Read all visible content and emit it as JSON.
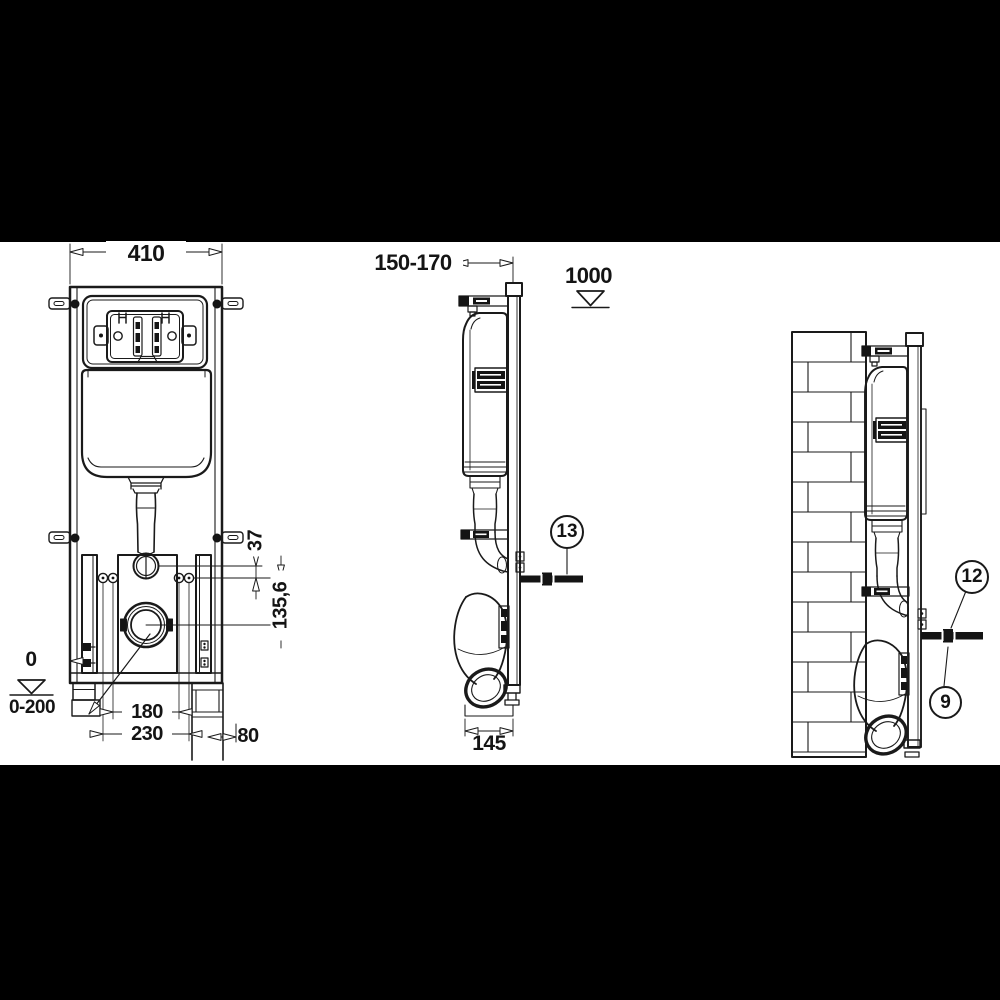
{
  "colors": {
    "background": "#000000",
    "sheet": "#ffffff",
    "line": "#1a1a1a"
  },
  "drawing": {
    "front_view": {
      "frame_width": "410",
      "flush_outlet_offset": "37",
      "drain_center_offset": "135,6",
      "floor_datum": "0",
      "foot_adjustment_range": "0-200",
      "fixing_bolt_spacing": "180",
      "outer_fixing_spacing": "230",
      "side_offset": "80"
    },
    "side_view": {
      "frame_depth_range": "150-170",
      "actuator_center_height": "1000",
      "base_depth": "145",
      "callout": "13"
    },
    "installed_view": {
      "callout_upper": "12",
      "callout_lower": "9"
    }
  }
}
